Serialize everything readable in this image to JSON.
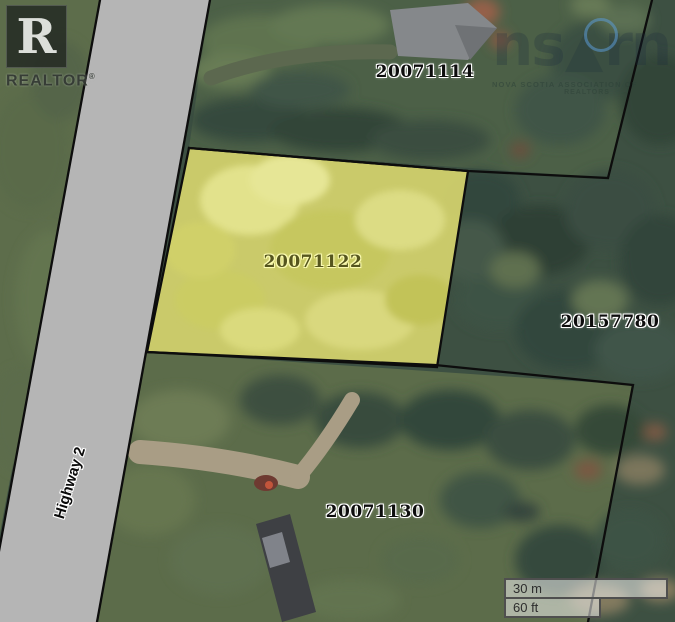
{
  "title": "Property parcel map",
  "map": {
    "parcels": [
      {
        "id": "20071114",
        "highlighted": false
      },
      {
        "id": "20071122",
        "highlighted": true
      },
      {
        "id": "20157780",
        "highlighted": false
      },
      {
        "id": "20071130",
        "highlighted": false
      }
    ],
    "road_label": "Highway 2"
  },
  "scale_bar": {
    "metric": "30 m",
    "imperial": "60 ft"
  },
  "realtor_logo": {
    "letter": "R",
    "word": "REALTOR",
    "registered": "®"
  },
  "watermark": {
    "big_left": "ns",
    "big_right": "rn",
    "line1": "NOVA SCOTIA ASSOCIATION OF",
    "line2": "REALTORS"
  },
  "colors": {
    "road": "#b5b5b5",
    "boundary": "#0d0d0d",
    "forest_dark": "#3d5042",
    "field_green": "#5d6d4b",
    "top_parcel_green": "#4c6047",
    "bottom_field_green": "#5c6c4a",
    "highlight_fill": "#d2d16d",
    "highlight_label": "#55551e",
    "highlight_halo": "#fafab0",
    "label_text": "#0d0d0d",
    "label_halo": "#ffffff",
    "scalebar_border": "#4f4f4f",
    "watermark_blue": "#5b9bd5"
  }
}
